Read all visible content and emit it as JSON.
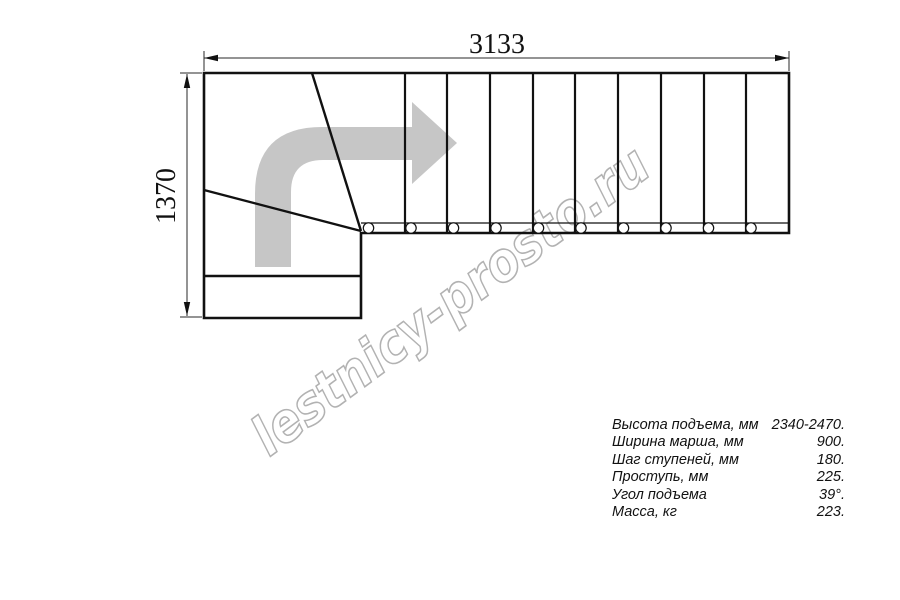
{
  "drawing": {
    "dimension_width": "3133",
    "dimension_height": "1370",
    "watermark": "lestnicy-prosto.ru",
    "line_color": "#111111",
    "arrow_color": "#c6c6c6",
    "watermark_color": "#b2b2b2"
  },
  "specs": {
    "rows": [
      {
        "label": "Высота подъема, мм",
        "value": "2340-2470."
      },
      {
        "label": "Ширина марша, мм",
        "value": "900."
      },
      {
        "label": "Шаг ступеней, мм",
        "value": "180."
      },
      {
        "label": "Проступь, мм",
        "value": "225."
      },
      {
        "label": "Угол подъема",
        "value": "39°."
      },
      {
        "label": "Масса, кг",
        "value": "223."
      }
    ]
  }
}
